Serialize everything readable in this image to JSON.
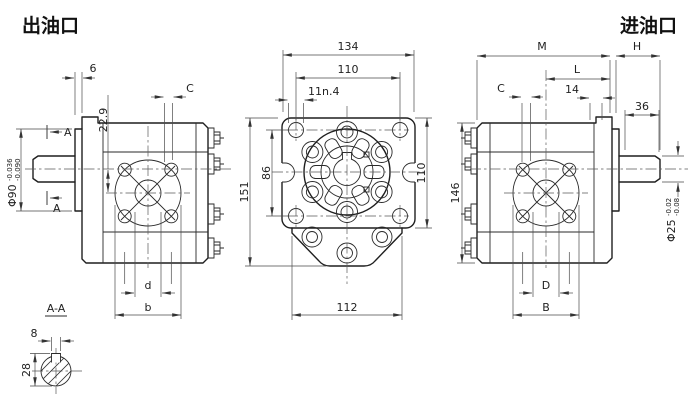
{
  "titles": {
    "outlet": "出油口",
    "inlet": "进油口",
    "section_label": "A-A"
  },
  "left_view": {
    "marker_a_top": "A",
    "marker_a_bottom": "A",
    "dim_spigot_width": "6",
    "dim_offset": "22.9",
    "dim_port": "C",
    "spigot_dia": "Φ90",
    "spigot_tol_upper": "-0.036",
    "spigot_tol_lower": "-0.090",
    "dim_bore": "d",
    "dim_boss": "b"
  },
  "front_view": {
    "dim_width": "134",
    "dim_hole_span": "110",
    "dim_hole": "11n.4",
    "dim_height_total": "151",
    "dim_hole_span_v": "86",
    "dim_flange_height": "110",
    "dim_base": "112"
  },
  "right_view": {
    "dim_m": "M",
    "dim_h": "H",
    "dim_l": "L",
    "dim_14": "14",
    "dim_port": "C",
    "dim_shaft_len": "36",
    "dim_height": "146",
    "shaft_dia": "Φ25",
    "shaft_tol_upper": "-0.02",
    "shaft_tol_lower": "-0.08",
    "dim_bore": "D",
    "dim_boss": "B"
  },
  "section_view": {
    "dim_key_width": "8",
    "dim_key_height": "28"
  }
}
